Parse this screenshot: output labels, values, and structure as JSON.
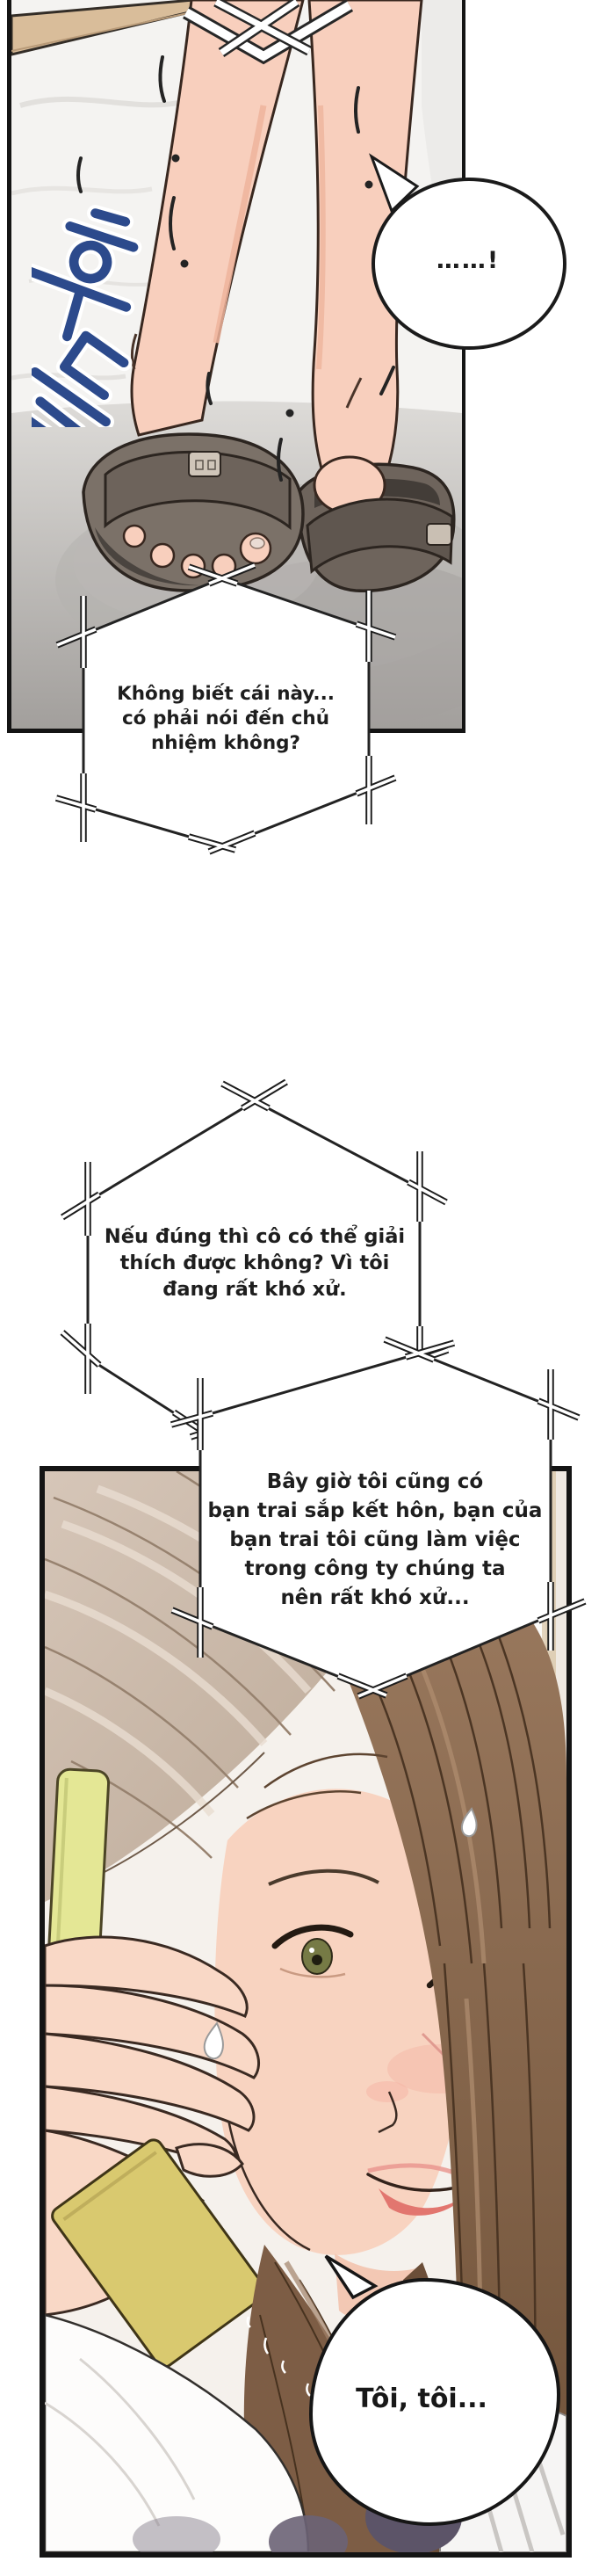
{
  "page": {
    "type": "webtoon-comic-page"
  },
  "sfx": {
    "korean_text": "후들",
    "color": "#2c4a8c"
  },
  "speech": {
    "exclaim": {
      "text": "……!"
    },
    "hex1": {
      "text": "Không biết cái này...\ncó phải nói đến chủ\nnhiệm không?"
    },
    "hex2": {
      "text": "Nếu đúng thì cô có thể giải\nthích được không? Vì tôi\nđang rất khó xử."
    },
    "hex3": {
      "text": "Bây giờ tôi cũng có\nbạn trai sắp kết hôn, bạn của\nbạn trai tôi cũng làm việc\ntrong công ty chúng ta\nnên rất khó xử..."
    },
    "toi": {
      "text": "Tôi, tôi..."
    }
  },
  "colors": {
    "panel_border": "#141414",
    "bubble_outline": "#1b1b1b",
    "sfx_blue": "#2c4a8c",
    "skin": "#f8d3c0",
    "hair_brown": "#8a6950",
    "hair_light": "#c9b6a7",
    "slipper_gray": "#6e645c",
    "floor_gray": "#b3b0ad",
    "phone_yellow": "#e4e795",
    "wood_beam": "#d9bd9a"
  }
}
